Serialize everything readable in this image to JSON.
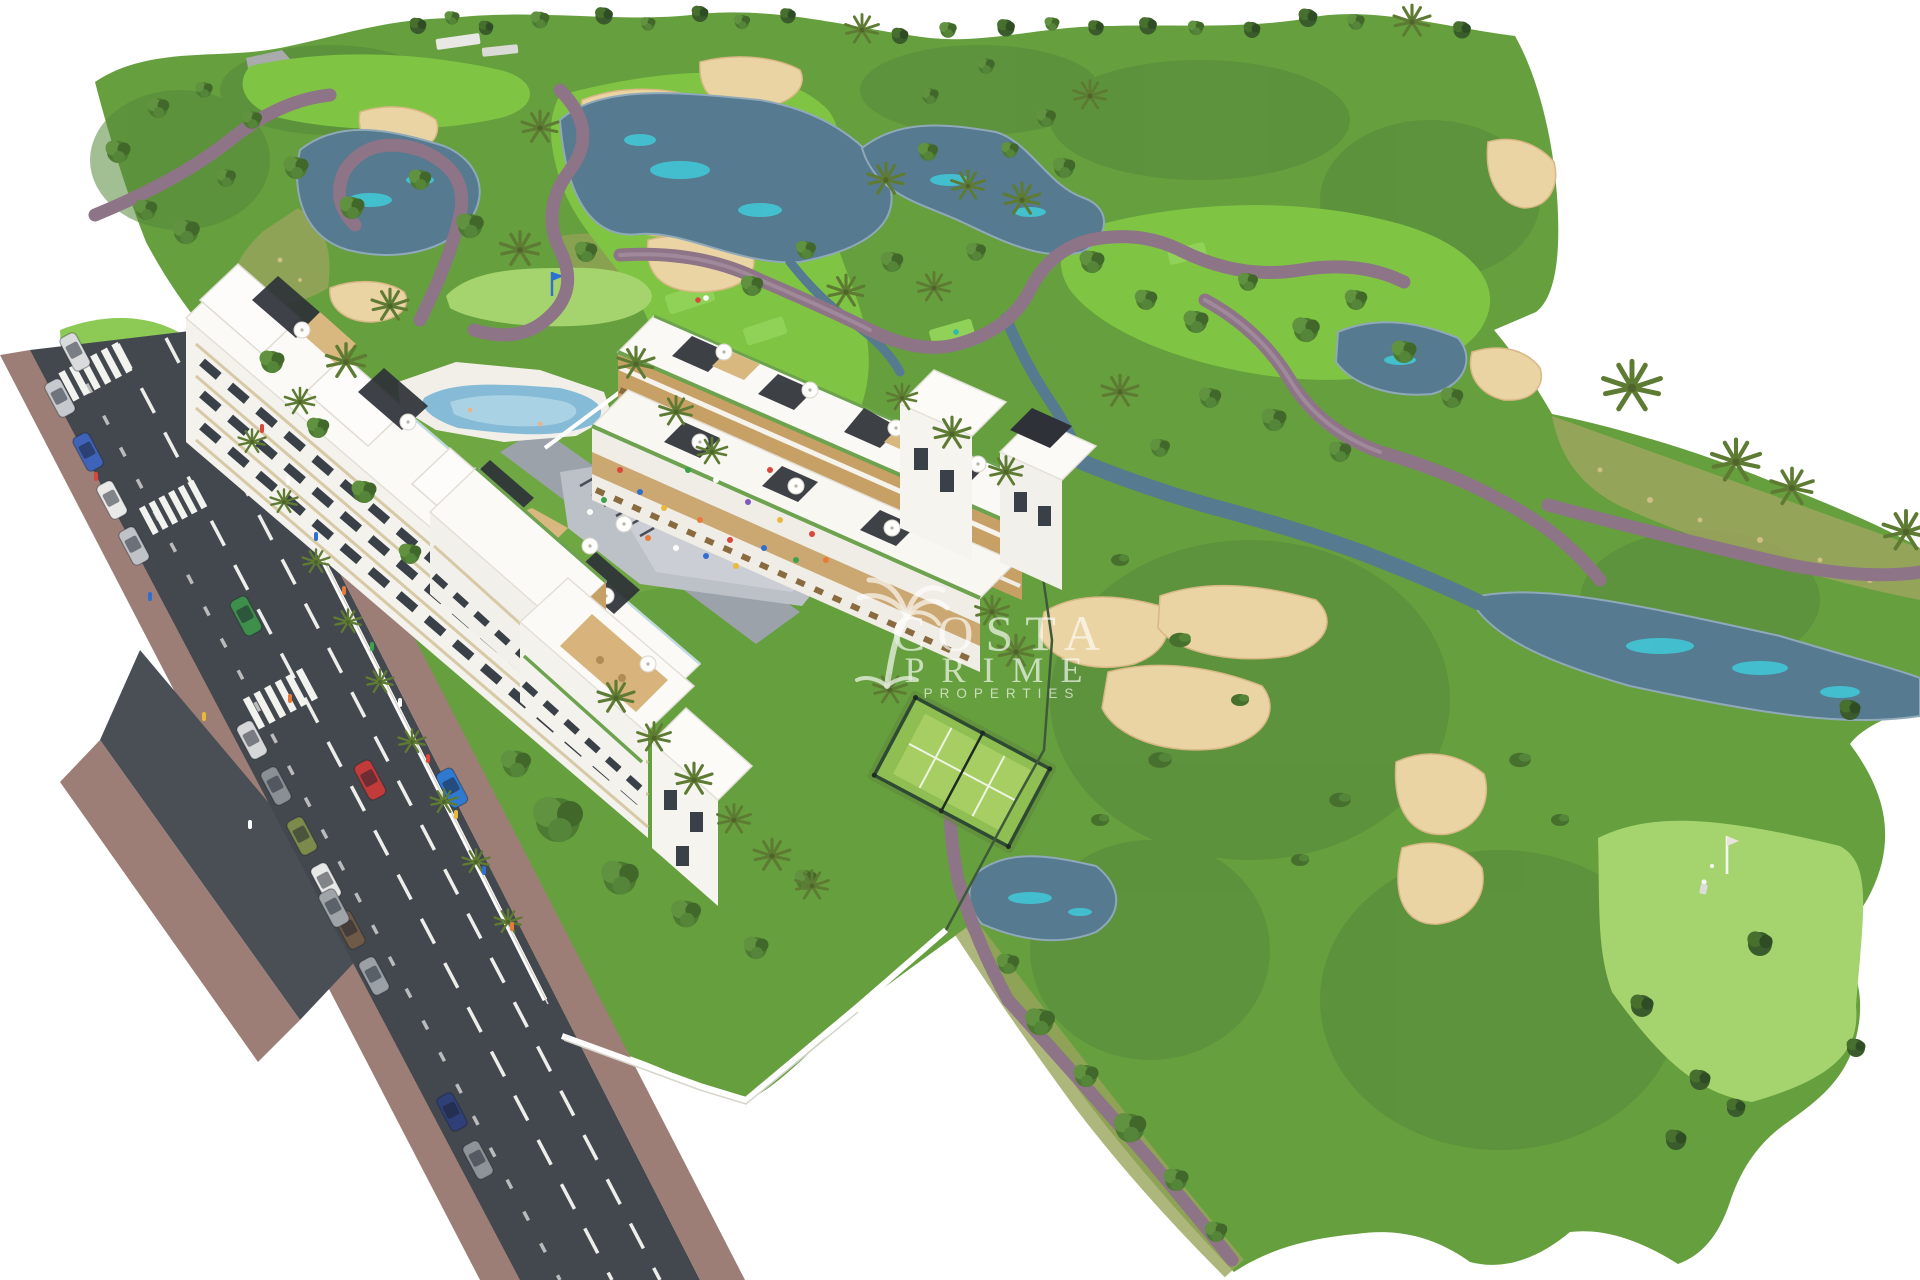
{
  "watermark": {
    "line1": "COSTA",
    "line2": "PRIME",
    "line3": "PROPERTIES",
    "logo_icon": "palm-tree-icon"
  },
  "palette": {
    "background": "#FFFFFF",
    "rough_green": "#669F3E",
    "dark_green": "#55883A",
    "fairway_green": "#7FC443",
    "putting_green": "#A5D46E",
    "scrub_olive": "#99A45B",
    "sand": "#EBD4A4",
    "water": "#567A8F",
    "water_teal": "#3FCBD9",
    "path_mauve": "#8E7487",
    "road_asphalt": "#43474E",
    "sidewalk": "#9C7E77",
    "plaza_gray": "#BCC0C7",
    "padel_green": "#8FBE53",
    "building_white": "#F4F2EC",
    "wood_accent": "#C7A065",
    "flag_blue": "#2F6FD0"
  },
  "scene": {
    "kind": "aerial-3d-render",
    "features": [
      "golf-course",
      "lakes",
      "sand-bunkers",
      "cart-paths",
      "apartment-buildings",
      "swimming-pool",
      "playground",
      "padel-court",
      "road-with-cars",
      "putting-green-with-golfer"
    ]
  }
}
